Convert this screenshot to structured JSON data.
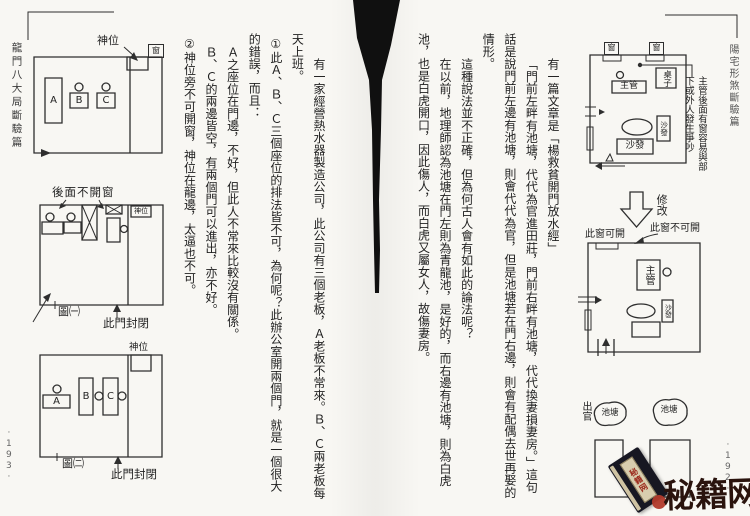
{
  "left_page": {
    "spine_title": "龍門八大局斷驗篇",
    "page_number": "·193·",
    "paragraphs": [
      "有一家經營熱水器製造公司，此公司有三個老板，Ａ老板不常來。Ｂ、Ｃ兩老板每天上班。",
      "①此Ａ、Ｂ、Ｃ三個座位的排法皆不可，為何呢？此辦公室開兩個門，就是一個很大的錯誤，而且：",
      "Ａ之座位在門邊，不好，但此人不常來比較沒有關係。",
      "Ｂ、Ｃ的兩邊皆空，有兩個門可以進出，亦不好。",
      "②神位旁不可開窗，神位在龍邊，太逼也不可。"
    ],
    "fig1": {
      "shrine_label": "神位",
      "window_label": "窗",
      "seat_a": "A",
      "seat_b": "B",
      "seat_c": "C"
    },
    "fig2": {
      "back_window_label": "後面不開窗",
      "shrine_label": "神位",
      "caption": "圖㈠",
      "door_label": "此門封閉"
    },
    "fig3": {
      "shrine_label": "神位",
      "seat_a": "A",
      "seat_b": "B",
      "seat_c": "C",
      "caption": "圖㈡",
      "door_label": "此門封閉"
    }
  },
  "right_page": {
    "spine_title": "陽宅形煞斷驗篇",
    "page_number": "·192·",
    "paragraphs": [
      "有一篇文章是「楊救貧開門放水經」",
      "「門前左畔有池塘，代代為官進田莊，門前右畔有池塘，代代換妻損妻房。」這句話是說門前左邊有池塘，則會代代為官，但是池塘若在門右邊，則會有配偶去世再娶的情形。",
      "這種說法並不正確，但為何古人會有如此的論法呢？",
      "在以前，地理師認為池塘在門左則為青龍池，是好的，而右邊有池塘，則為白虎池，也是白虎開口，因此傷人，而白虎又屬女人，故傷妻房。"
    ],
    "figA": {
      "window1": "窗",
      "window2": "窗",
      "desk_label": "桌子",
      "manager_label": "主管",
      "sofa_right": "沙發",
      "sofa_bottom": "沙發",
      "annotation": "主管後面有窗容易與部下或外人發生爭吵"
    },
    "modify_label": "修改",
    "figB": {
      "window_open": "此窗可開",
      "window_closed": "此窗不可開",
      "manager_label": "主管",
      "sofa_label": "沙發"
    },
    "figC": {
      "exit_label": "出官",
      "pond_left": "池塘",
      "pond_right": "池塘"
    }
  },
  "watermark": {
    "site_name": "秘籍网",
    "book_spine_text": "秘籍网"
  }
}
